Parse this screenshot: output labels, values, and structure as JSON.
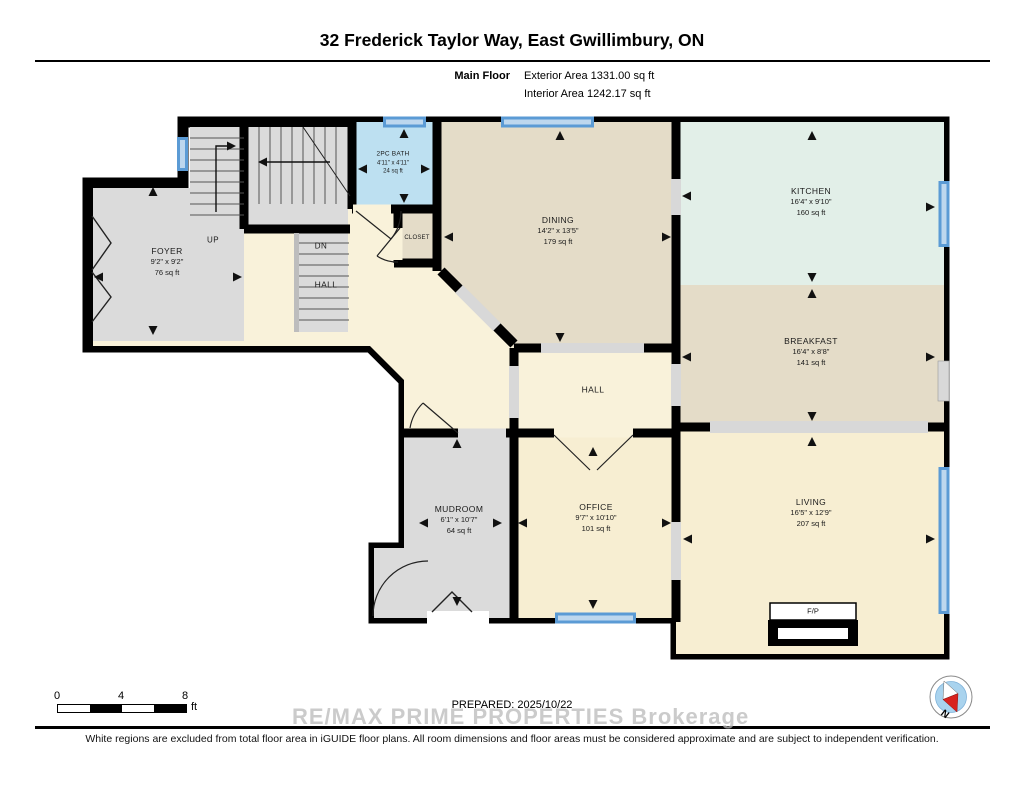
{
  "header": {
    "title": "32 Frederick Taylor Way, East Gwillimbury, ON",
    "floor_label": "Main Floor",
    "exterior_area": "Exterior Area 1331.00 sq ft",
    "interior_area": "Interior Area 1242.17 sq ft"
  },
  "rooms": {
    "foyer": {
      "name": "FOYER",
      "dims": "9'2\" x 9'2\"",
      "area": "76 sq ft"
    },
    "bath": {
      "name": "2PC BATH",
      "dims": "4'11\" x 4'11\"",
      "area": "24 sq ft"
    },
    "closet": {
      "name": "CLOSET"
    },
    "hall": {
      "name": "HALL"
    },
    "hall_center": {
      "name": "HALL"
    },
    "dining": {
      "name": "DINING",
      "dims": "14'2\" x 13'5\"",
      "area": "179 sq ft"
    },
    "kitchen": {
      "name": "KITCHEN",
      "dims": "16'4\" x 9'10\"",
      "area": "160 sq ft"
    },
    "breakfast": {
      "name": "BREAKFAST",
      "dims": "16'4\" x 8'8\"",
      "area": "141 sq ft"
    },
    "living": {
      "name": "LIVING",
      "dims": "16'5\" x 12'9\"",
      "area": "207 sq ft"
    },
    "office": {
      "name": "OFFICE",
      "dims": "9'7\" x 10'10\"",
      "area": "101 sq ft"
    },
    "mudroom": {
      "name": "MUDROOM",
      "dims": "6'1\" x 10'7\"",
      "area": "64 sq ft"
    },
    "stairs_up_label": "UP",
    "stairs_down_label": "DN",
    "fireplace_label": "F/P"
  },
  "scale_bar": {
    "ticks": [
      "0",
      "4",
      "8"
    ],
    "unit": "ft"
  },
  "compass": {
    "north_label": "N"
  },
  "footer": {
    "prepared_label": "PREPARED: 2025/10/22",
    "watermark": "RE/MAX PRIME PROPERTIES  Brokerage",
    "disclaimer": "White regions are excluded from total floor area in iGUIDE floor plans. All room dimensions and floor areas must be considered approximate and are subject to independent verification."
  },
  "colors": {
    "wall": "#000000",
    "hall_cream": "#F9F2DA",
    "room_cream": "#F7EED2",
    "tan": "#E4DCC8",
    "gray": "#DBDBDB",
    "mint": "#E2EFE8",
    "bath_blue": "#BDE0F1",
    "window_blue": "#5B9BD5",
    "threshold_gray": "#D8D8D8"
  }
}
